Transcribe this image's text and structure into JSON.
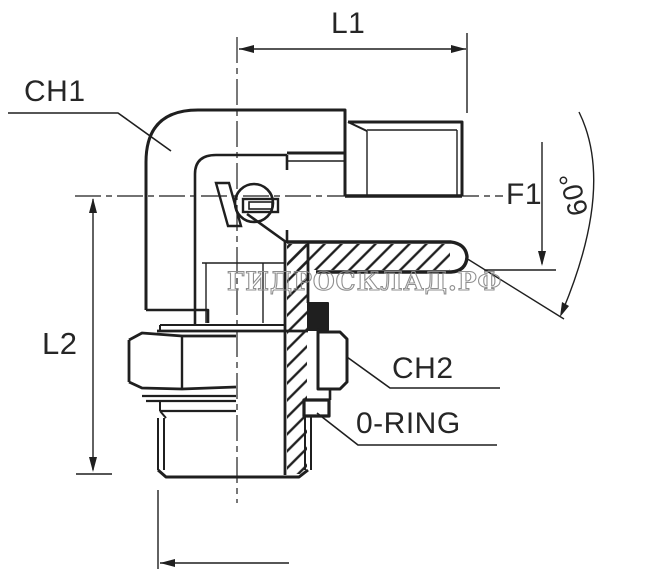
{
  "drawing": {
    "title": "90-degree elbow hydraulic fitting technical drawing",
    "labels": {
      "ch1": "CH1",
      "l1": "L1",
      "f1": "F1",
      "angle": "60°",
      "l2": "L2",
      "ch2": "CH2",
      "oring": "0-RING"
    },
    "watermark": "ГИДРОСКЛАД.РФ",
    "colors": {
      "line": "#1f1f1f",
      "label": "#262626",
      "watermark": "#8a8a8a",
      "background": "#ffffff"
    }
  }
}
